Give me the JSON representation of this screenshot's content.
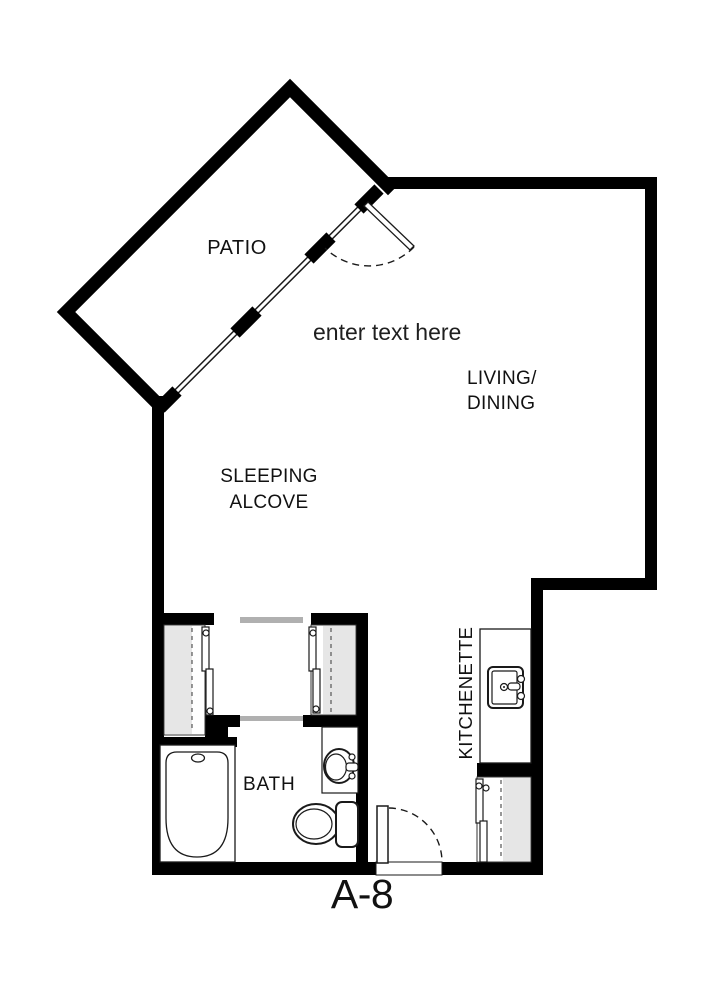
{
  "title": "Floor plan unit A-8",
  "unit": {
    "label": "A-8"
  },
  "rooms": {
    "patio": "PATIO",
    "living_dining_line1": "LIVING/",
    "living_dining_line2": "DINING",
    "sleeping_alcove_line1": "SLEEPING",
    "sleeping_alcove_line2": "ALCOVE",
    "kitchenette": "KITCHENETTE",
    "bath": "BATH"
  },
  "placeholder": {
    "text": "enter text here"
  },
  "fixtures": [
    "bathtub",
    "toilet",
    "bath-sink",
    "kitchen-sink",
    "entry-door",
    "patio-door",
    "closet-1",
    "closet-2",
    "closet-3"
  ],
  "colors": {
    "wall": "#000000",
    "background": "#ffffff",
    "header_gray": "#b0b0b0",
    "closet_shade": "#e6e6e6",
    "fixture_stroke": "#1a1a1a",
    "text": "#111111"
  }
}
